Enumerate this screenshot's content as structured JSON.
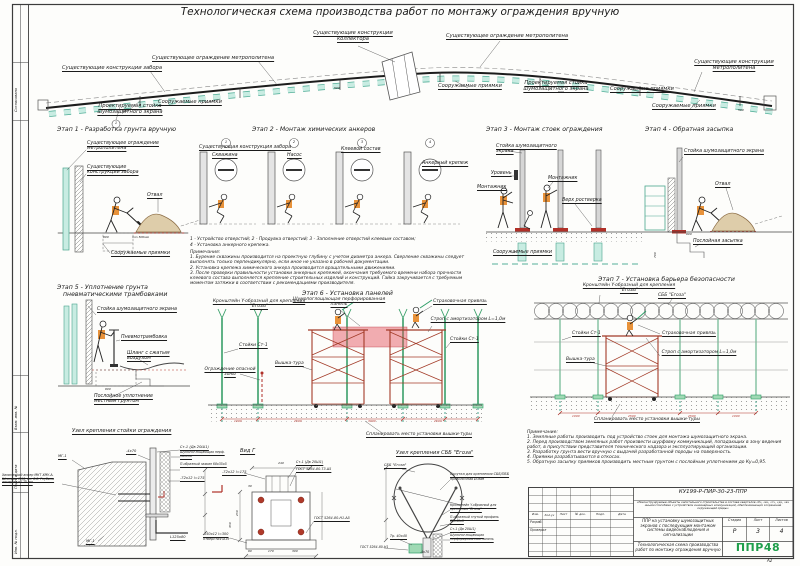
{
  "sheet": {
    "title": "Технологическая схема производства работ по монтажу ограждения вручную",
    "format": "А2",
    "frame_sogl": "Согласовано",
    "frame_vzam": "Взам. инв. №",
    "frame_podp": "Подп. и дата",
    "frame_inv": "Инв. № подл."
  },
  "plan": {
    "fence": "Существующие конструкции забора",
    "metro1": "Существующее ограждение метрополитена",
    "metro2": "Существующее ограждение метрополитена",
    "collector": "Существующие конструкции коллектора",
    "metroc": "Существующие конструкции метрополитена",
    "pits": "Сооружаемые приямки",
    "post": "Проектируемая стойка шумозащитного экрана",
    "d500": "500",
    "axis1": "1"
  },
  "s1": {
    "t": "Этап 1 - Разработка грунта вручную",
    "metro": "Существующее ограждение метрополитена",
    "fence": "Существующие конструкции забора",
    "otval": "Отвал",
    "pits": "Сооружаемые приямки",
    "d600": "600",
    "dmin": "min 500мм"
  },
  "s2": {
    "t": "Этап 2 - Монтаж химических анкеров",
    "wall": "Существующая конструкция забора",
    "skv": "Скважина",
    "nasos": "Насос",
    "glue": "Клеевой состав",
    "anchor": "Анкерный крепеж",
    "nums": [
      "1",
      "2",
      "3",
      "4"
    ],
    "cap1": "1 - Устройство отверстий; 2 - Продувка отверстий; 3 - Заполнение отверстий клеевым составом;",
    "cap2": "4 - Установка анкерного крепежа.",
    "nt": "Примечания:",
    "n1": "1. Бурение скважины производится на проектную глубину с учетом диаметра анкера. Сверление скважины следует выполнять только перпендикулярно, если иное не указано в рабочей документации.",
    "n2": "2. Установка крепежа химического анкера производится вращательными движениями.",
    "n3": "3. После проверки правильности установки анкерных крепежей, окончания требуемого времени набора прочности клеевого состава выполняется крепление строительных изделий и конструкций. Гайка закручивается с требуемым моментом затяжки в соответствии с рекомендациями производителя."
  },
  "s3": {
    "t": "Этап 3 - Монтаж стоек ограждения",
    "post": "Стойка шумозащитного экрана",
    "level": "Уровень",
    "w1": "Монтажник",
    "w2": "Монтажник",
    "rost": "Верх ростверка",
    "pits": "Сооружаемые приямки"
  },
  "s4": {
    "t": "Этап 4 - Обратная засыпка",
    "post": "Стойка шумозащитного экрана",
    "otval": "Отвал",
    "back": "Послойная засыпка",
    "d600": "600",
    "d700": "700"
  },
  "s5": {
    "t1": "Этап 5 - Уплотнение грунта",
    "t2": "пневматическими трамбовками",
    "post": "Стойка шумозащитного экрана",
    "ram": "Пневмотрамбовка",
    "hose": "Шланг с сжатым воздухом",
    "comp": "Послойное уплотнение местным грунтом",
    "d600": "600"
  },
  "s6": {
    "t": "Этап 6 - Установка панелей",
    "bracket": "Кронштейн Y-образный для крепления \"Егозы\"",
    "panel": "Шумопоглощающая перфорированная панель",
    "harness": "Страховочная привязь",
    "strop": "Строп с амортизатором L=1,0м",
    "postsl": "Стойки Ст-1",
    "postsr": "Стойки Ст-1",
    "tower": "Вышка-тура",
    "danger": "Ограждение опасной зоны",
    "place": "Спланировать место установки вышки-туры",
    "dims": [
      "1000",
      "2500",
      "3000",
      "2500"
    ]
  },
  "s7": {
    "t": "Этап 7 - Установка барьера безопасности",
    "bracket": "Кронштейн Y-образный для крепления \"Егозы\"",
    "sbb": "СББ \"Егоза\"",
    "posts": "Стойки Ст-1",
    "tower": "Вышка-тура",
    "harness": "Страховочная привязь",
    "strop": "Строп с амортизатором L=1,0м",
    "place": "Спланировать место установки вышки-туры",
    "dims": [
      "1000",
      "2500",
      "2500",
      "1000"
    ]
  },
  "n1": {
    "t": "Узел крепления стойки ограждения",
    "mg1t": "МГ-1",
    "anchor": "Химический анкер МКТ ХМУ-А. Шпилька М16, кл. 8.8. Глубина анкеровки 170 мм",
    "plate": "-4х70",
    "st1": "Ст-1 (Дв 20Ш1)",
    "panel": "Шумопоглощающая перф. панель",
    "clamp": "П-образный зажим 68х35х5",
    "strip": "-72х12 l=175",
    "angle": "L125х80",
    "mg1b": "МГ-1"
  },
  "vg": {
    "t": "Вид Г",
    "strip": "-72х12 l=175",
    "st1": "Ст-1 (Дв 20Ш1)",
    "gost1": "ГОСТ 5264-80-Т3-∆5",
    "gost2": "ГОСТ 5264-80-Н1-∆5",
    "base": "-250х12 l=300",
    "holes": "отверстия Ø19",
    "d240": "240",
    "d30": "30",
    "d250": "250",
    "d350": "350",
    "d60": "60",
    "d170": "170",
    "d300": "300"
  },
  "eg": {
    "t": "Узел крепления СББ \"Егоза\"",
    "sbb": "СББ \"Егоза\"",
    "twist1": "Скрутка для крепления СББ/ПББ",
    "twist2": "проволочная Ø3мм",
    "bracket": "Кронштейн Y-образный для крепления \"Егозы\"",
    "profile": "П-образный гнутый профиль 85х40х5",
    "st1": "Ст-1 (Дв 20Ш1)",
    "panel": "Шумопоглощающая перфорированная панель",
    "tube": "Тр. 40х40",
    "gost": "ГОСТ 5264-80-Н1",
    "plate": "-4х70"
  },
  "notes": {
    "t": "Примечание:",
    "i1": "1. Земляные работы производить под устройство стоек для монтажа шумозащитного экрана.",
    "i2": "2. Перед производством земляных работ произвести шурфовку коммуникаций, попадающих в зону ведения работ, в присутствии представителя технического надзора и эксплуатирующей организации.",
    "i3": "3. Разработку грунта вести вручную с выдачей разработанной породы на поверхность.",
    "i4": "4. Приямки разрабатываются в откосах.",
    "i5": "5. Обратную засыпку приямков производить местным грунтом с послойным уплотнением до Ку=0,95."
  },
  "tb": {
    "code": "КУ199-Р-ПИР-30-23-ППР",
    "project": "«Реконструируемые объекты капитального строительства в составе кварталов «б», «в», «г», «д», «е» иными способами с устройством инженерных коммуникаций, обеспечивающих сохранение окружающей среды»",
    "ppr": "ППР на установку шумозащитных экранов с последующим монтажом системы видеонаблюдения и сигнализации",
    "sheet": "Технологическая схема производства работ по монтажу ограждения вручную",
    "izm": "Изм.",
    "koluch": "Кол.уч",
    "list": "Лист",
    "ndok": "№ док.",
    "podp": "Подп.",
    "data": "Дата",
    "razrab": "Разраб.",
    "prover": "Проверил",
    "stageh": "Стадия",
    "listh": "Лист",
    "listovh": "Листов",
    "stagev": "Р",
    "listv": "3",
    "listovv": "4",
    "logo": "ППР48"
  }
}
